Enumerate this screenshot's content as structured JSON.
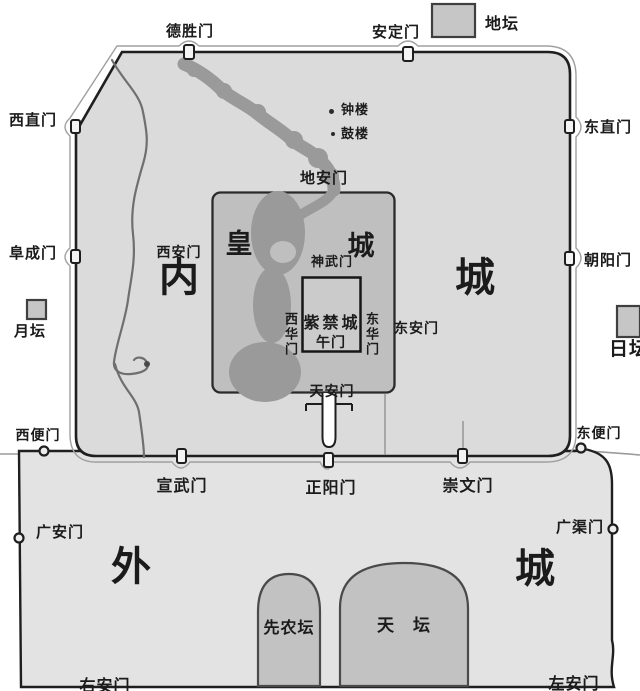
{
  "colors": {
    "wall": "#1f1f1f",
    "inner_fill": "#dbdbdb",
    "outer_fill": "#e3e3e3",
    "imperial_fill": "#bfbfbf",
    "fc_fill": "#cbcbcb",
    "water": "#9a9a9a",
    "altar_fill": "#c6c6c6",
    "bg": "#ffffff",
    "text": "#1b1b1b"
  },
  "regions": {
    "inner_city_char_west": "内",
    "inner_city_char_east": "城",
    "outer_city_char_west": "外",
    "outer_city_char_east": "城",
    "imperial_char_west": "皇",
    "imperial_char_east": "城",
    "forbidden_city": "紫禁城"
  },
  "inner_city_gates": {
    "deshengmen": "德胜门",
    "andingmen": "安定门",
    "xizhimen": "西直门",
    "fuchengmen": "阜成门",
    "dongzhimen": "东直门",
    "chaoyangmen": "朝阳门",
    "xuanwumen": "宣武门",
    "zhengyangmen": "正阳门",
    "chongwenmen": "崇文门"
  },
  "imperial_gates": {
    "dianmen": "地安门",
    "xianmen": "西安门",
    "donganmen": "东安门",
    "shenwumen": "神武门",
    "wumen": "午门",
    "xihuamen": "西华门",
    "donghuamen": "东华门",
    "tiananmen": "天安门"
  },
  "outer_city_gates": {
    "xibianmen": "西便门",
    "dongbianmen": "东便门",
    "guanganmen": "广安门",
    "guangqumen": "广渠门",
    "youanmen": "右安门",
    "zuoanmen": "左安门"
  },
  "landmarks": {
    "ditan": "地坛",
    "yuetan": "月坛",
    "ritan": "日坛",
    "xiannongtan": "先农坛",
    "tiantan": "天　坛",
    "zhonglou": "钟楼",
    "gulou": "鼓楼"
  }
}
